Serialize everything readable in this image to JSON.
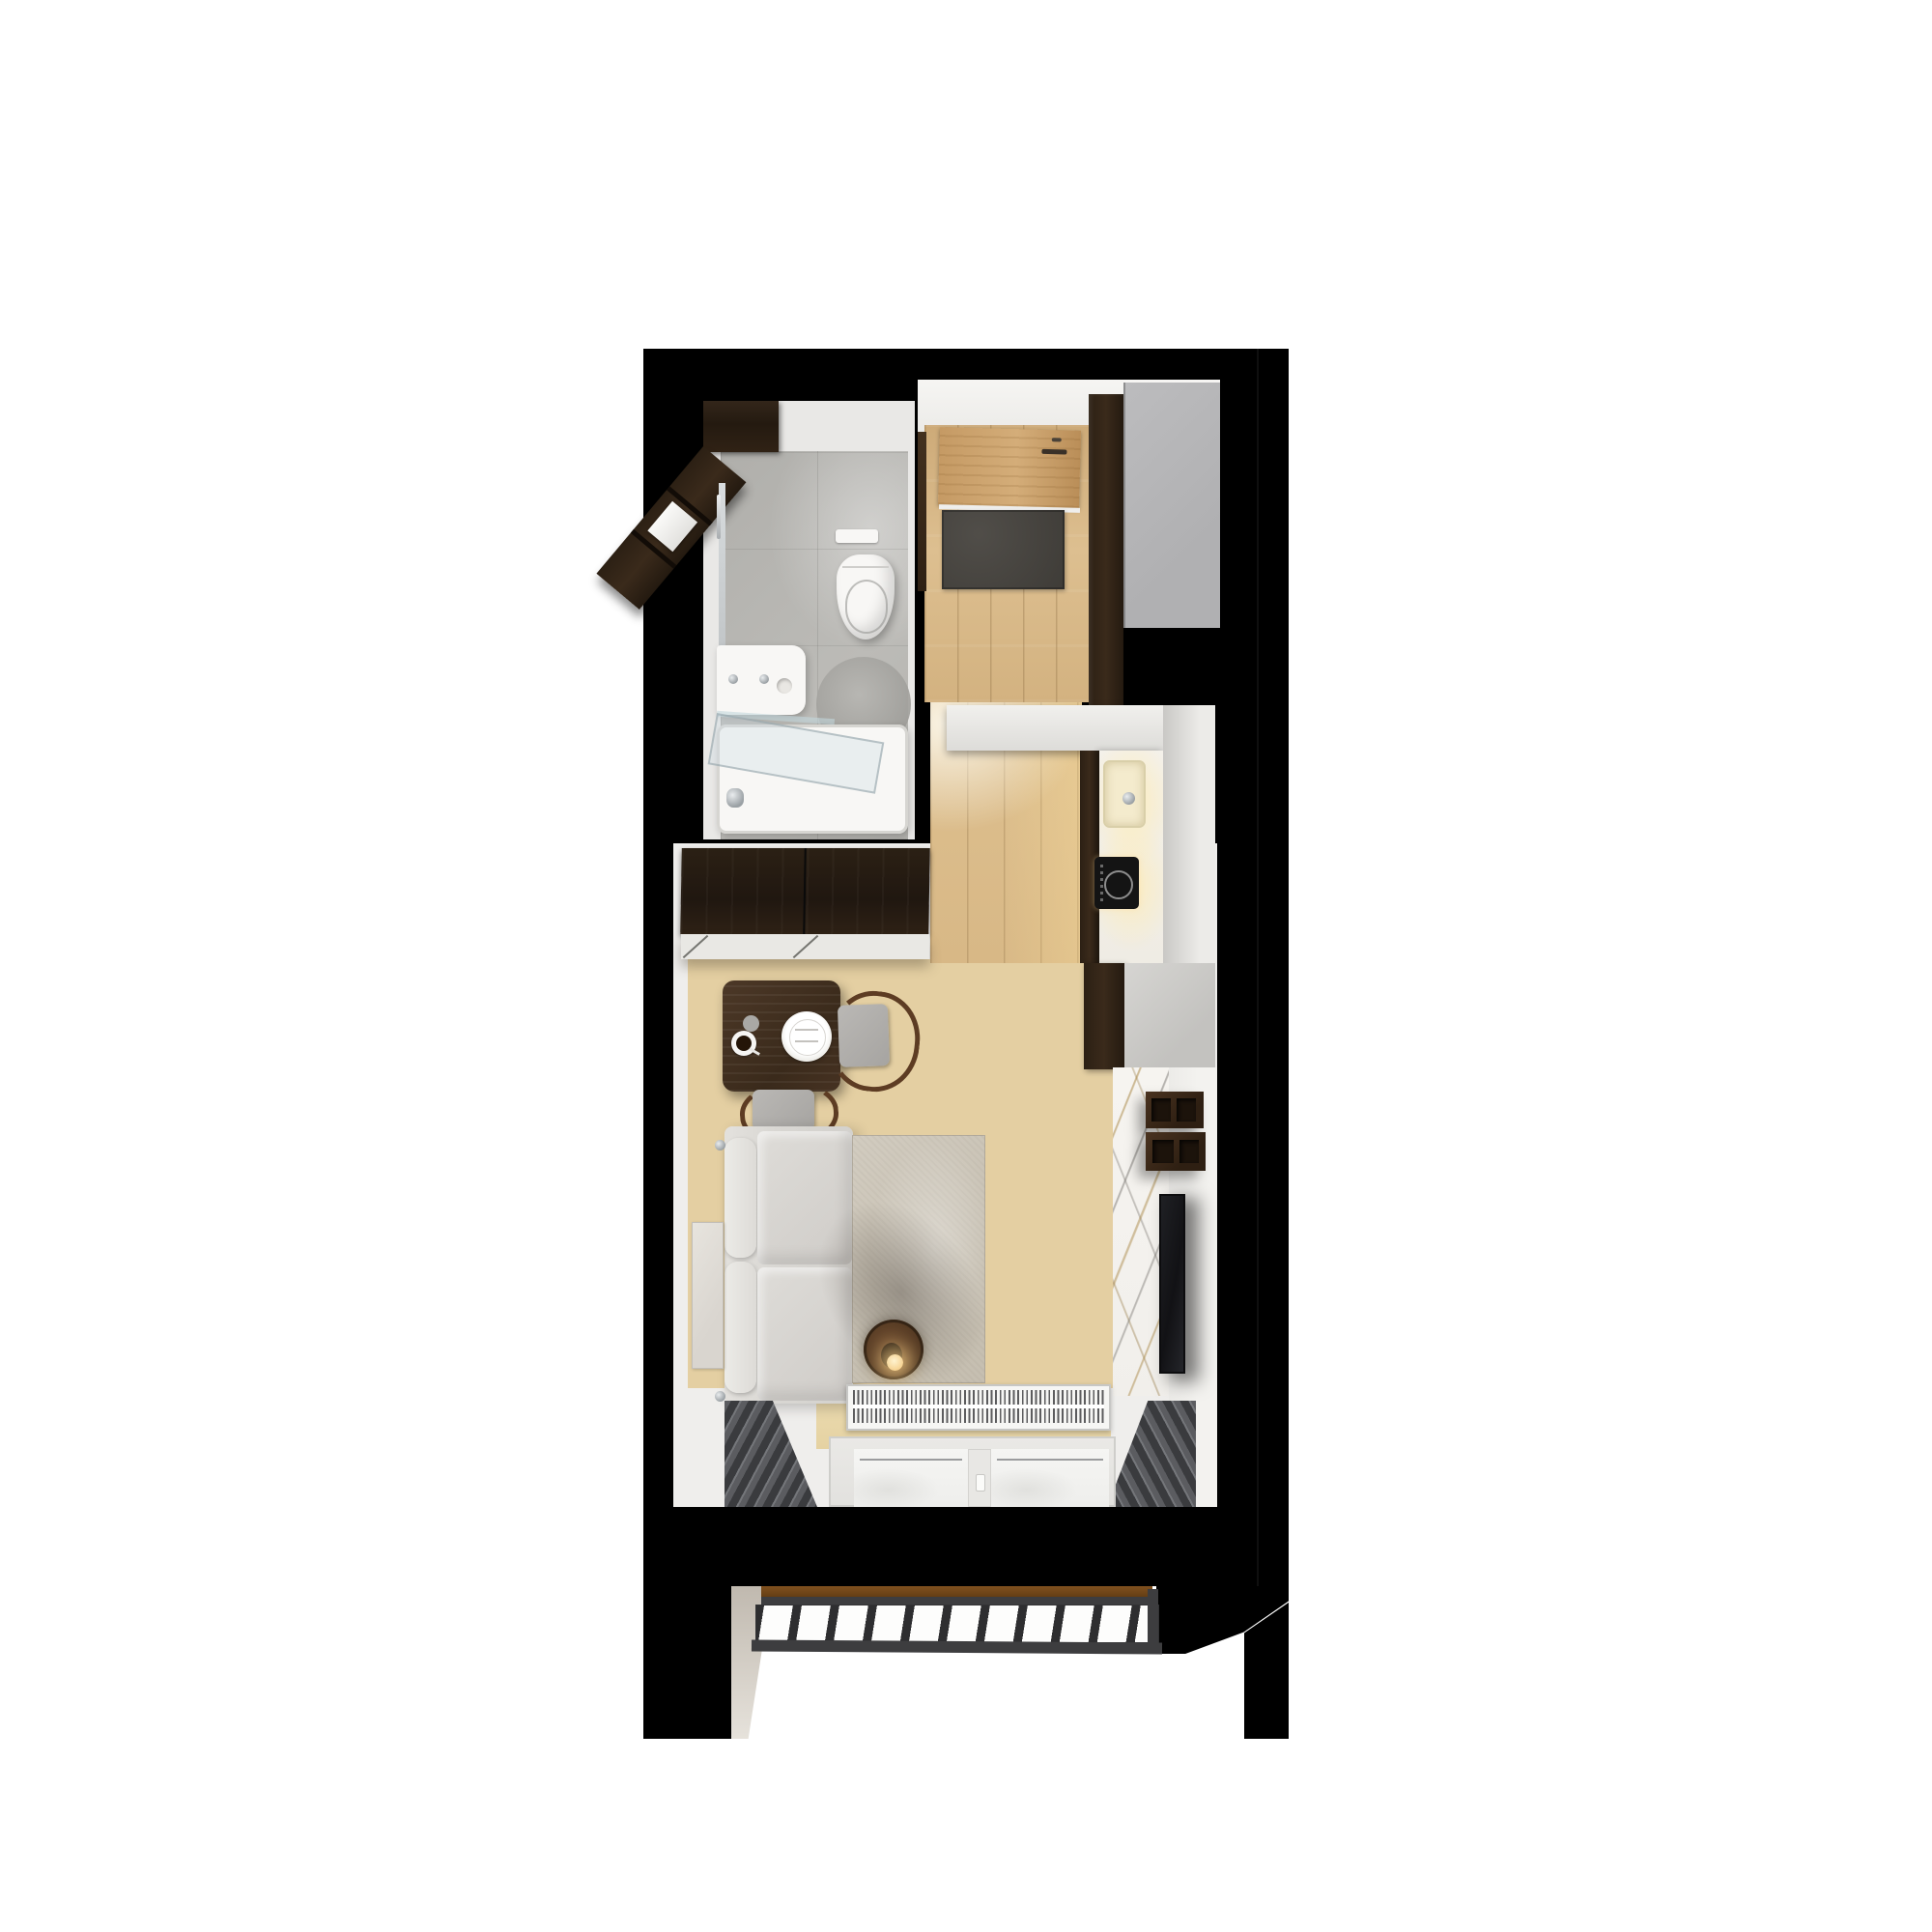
{
  "scene": {
    "type": "top-down 3D rendered floor plan of a studio apartment",
    "page_background": "#ffffff",
    "outer_walls": "#000000",
    "no_visible_text": true
  },
  "palette": {
    "page_bg": "#ffffff",
    "wall_black": "#000000",
    "room_white": "#efeeec",
    "floor_wood": "#e4cfa2",
    "floor_wood_hall": "#d6b284",
    "wood_dark": "#2b2014",
    "chair_frame_wood": "#5d3c23",
    "door_wood": "#c59a64",
    "gray_wardrobe": "#b5b5b7",
    "tile_gray": "#b5b4b0",
    "fixture_white": "#f8f7f5",
    "counter_white": "#f2efe8",
    "sink_cream": "#f4ebcd",
    "hob_black": "#141414",
    "marble_base": "#f5f3ef",
    "marble_vein_gold": "#ab8a4a",
    "marble_vein_gray": "#7d7b78",
    "sofa_gray": "#d8d6d2",
    "rug_beige": "#ccc5b7",
    "curtain_gray": "#47484b",
    "radiator_white": "#f6f6f4",
    "radiator_fin": "#5c5c5e",
    "window_pane": "#f3f3f1",
    "doormat_gray": "#47443f",
    "grate_frame": "#3d3d3f",
    "threshold_brown": "#6e4015",
    "lamp_glow": "#f2c477",
    "tv_black": "#17171a"
  },
  "rooms": {
    "bathroom": {
      "fixtures": [
        "wall-cabinet-wood",
        "tall-shelf-wood",
        "towel",
        "mirror",
        "towel-bar",
        "flush-plate",
        "wall-hung-toilet",
        "round-bath-mat",
        "vanity-sink",
        "faucets",
        "glass-shelf",
        "bathtub",
        "glass-screen",
        "gray-floor-tiles"
      ]
    },
    "hallway": {
      "fixtures": [
        "entry-door",
        "door-handle",
        "doormat",
        "wood-plank-floor",
        "tall-cabinet-wood",
        "gray-wardrobe"
      ]
    },
    "kitchen": {
      "fixtures": [
        "upper-cabinet-white",
        "counter-white",
        "sink-cream",
        "faucet",
        "induction-hob",
        "dark-cabinet-fronts",
        "tall-cabinet-wood",
        "side-panel-gray",
        "wood-plank-floor"
      ]
    },
    "living_room": {
      "fixtures": [
        "sliding-door-wardrobe",
        "dining-table",
        "dinner-plate",
        "coffee-cup",
        "napkin",
        "dining-chair-right",
        "dining-chair-bottom",
        "corner-sofa",
        "wall-art",
        "area-rug",
        "round-coffee-table",
        "table-lamp-glowing",
        "marble-accent-wall",
        "wall-shelf-boxes",
        "wall-mounted-tv",
        "radiator-grille",
        "curtains-left",
        "curtains-right",
        "double-window",
        "wood-plank-floor"
      ]
    },
    "balcony": {
      "fixtures": [
        "wood-threshold",
        "metal-grate-floor"
      ],
      "grate_gap_count": 14
    }
  },
  "window": {
    "pane_count": 2,
    "has_center_mullion_handle": true
  },
  "radiator": {
    "style": "trench grille with dense vertical fins"
  }
}
